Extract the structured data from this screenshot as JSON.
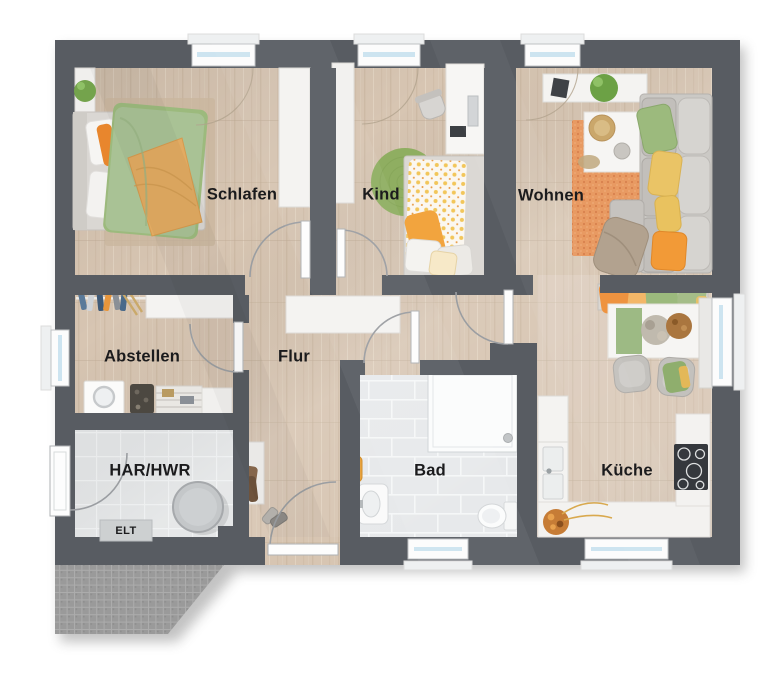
{
  "plan_title": "Erdgeschoss Grundriss",
  "rooms": [
    {
      "id": "schlafen",
      "label": "Schlafen"
    },
    {
      "id": "kind",
      "label": "Kind"
    },
    {
      "id": "wohnen",
      "label": "Wohnen"
    },
    {
      "id": "abstellen",
      "label": "Abstellen"
    },
    {
      "id": "flur",
      "label": "Flur"
    },
    {
      "id": "har-hwr",
      "label": "HAR/HWR"
    },
    {
      "id": "elt",
      "label": "ELT"
    },
    {
      "id": "bad",
      "label": "Bad"
    },
    {
      "id": "kueche",
      "label": "Küche"
    }
  ],
  "colors": {
    "wall": "#585c62",
    "floor_wood": "#d7c5b2",
    "floor_tile_bath": "#e6e8ea",
    "floor_tile_util": "#e3e5e6",
    "terrace": "#9a9a9a",
    "window_glass": "#cde4f0",
    "accent_orange": "#e89a62",
    "accent_green": "#9cba7d",
    "accent_yellow": "#eac466",
    "label_text": "#1b1b1d"
  }
}
